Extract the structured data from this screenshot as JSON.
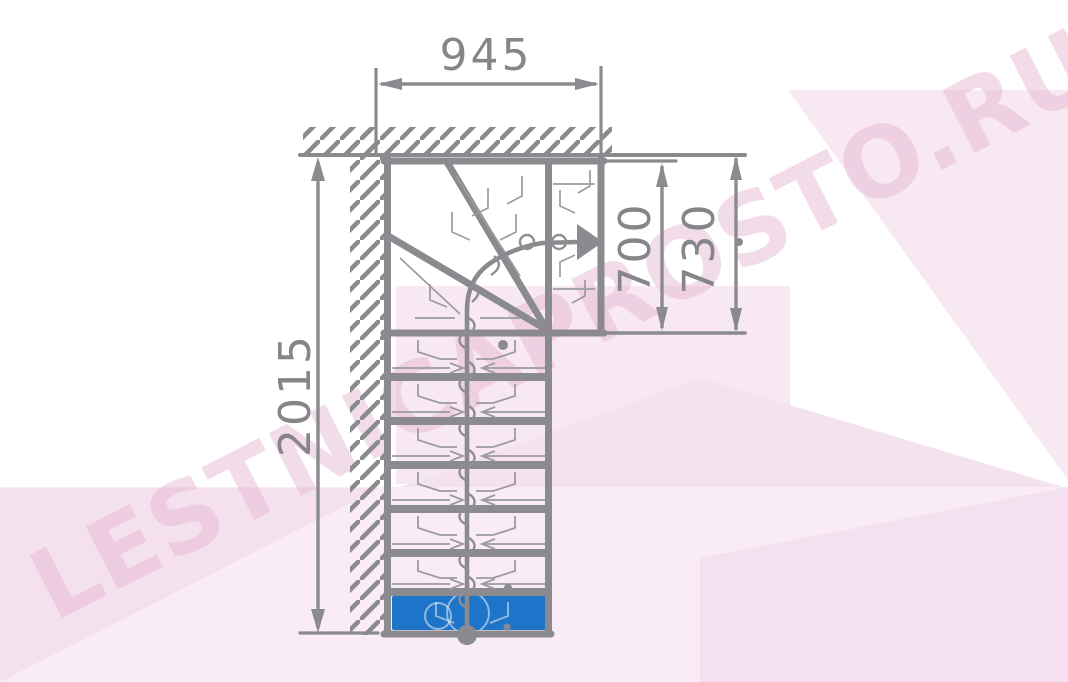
{
  "diagram": {
    "type": "staircase-plan-top-view",
    "watermark": {
      "text": "LESTNICAPROSTO.RU"
    },
    "dimensions": {
      "total_run": "2015",
      "top_width": "945",
      "exit_width_inner": "700",
      "exit_width_outer": "730"
    },
    "colors": {
      "line_gray": "#8b8b8f",
      "text_gray": "#85858a",
      "detail_gray": "#9b9ba0",
      "first_step_blue": "#1e74c8",
      "watermark_pink": "#f3dcea",
      "background": "#ffffff"
    },
    "icons": {
      "direction_arrow": "walkline-direction-arrow",
      "walkline_start": "walkline-start-dot"
    }
  }
}
